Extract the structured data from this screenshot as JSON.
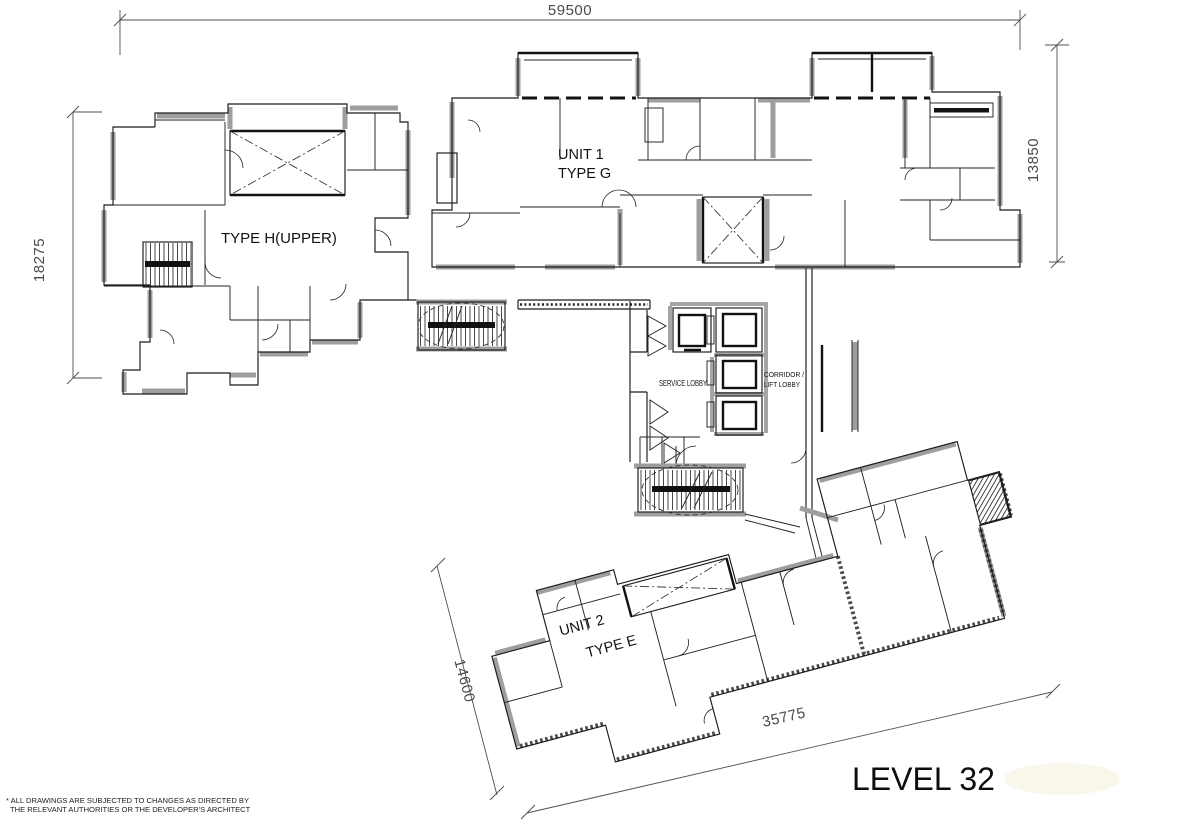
{
  "document": {
    "title": "LEVEL 32",
    "footnote_line1": "* ALL DRAWINGS ARE SUBJECTED TO CHANGES AS DIRECTED BY",
    "footnote_line2": "THE RELEVANT AUTHORITIES OR THE DEVELOPER'S ARCHITECT"
  },
  "units": {
    "unit1_line1": "UNIT 1",
    "unit1_line2": "TYPE G",
    "unit_h_label": "TYPE H(UPPER)",
    "unit2_line1": "UNIT 2",
    "unit2_line2": "TYPE E"
  },
  "core": {
    "service_lobby": "SERVICE LOBBY",
    "corridor_line1": "CORRIDOR /",
    "corridor_line2": "LIFT LOBBY"
  },
  "dimensions": {
    "top": "59500",
    "left": "18275",
    "right": "13850",
    "bottom_left": "14600",
    "bottom": "35775"
  },
  "colors": {
    "wall_dark": "#1a1a1a",
    "wall_gray": "#9e9e9e",
    "dim_text": "#4a4a4a",
    "title_text": "#0d0d0d",
    "background": "#ffffff"
  }
}
